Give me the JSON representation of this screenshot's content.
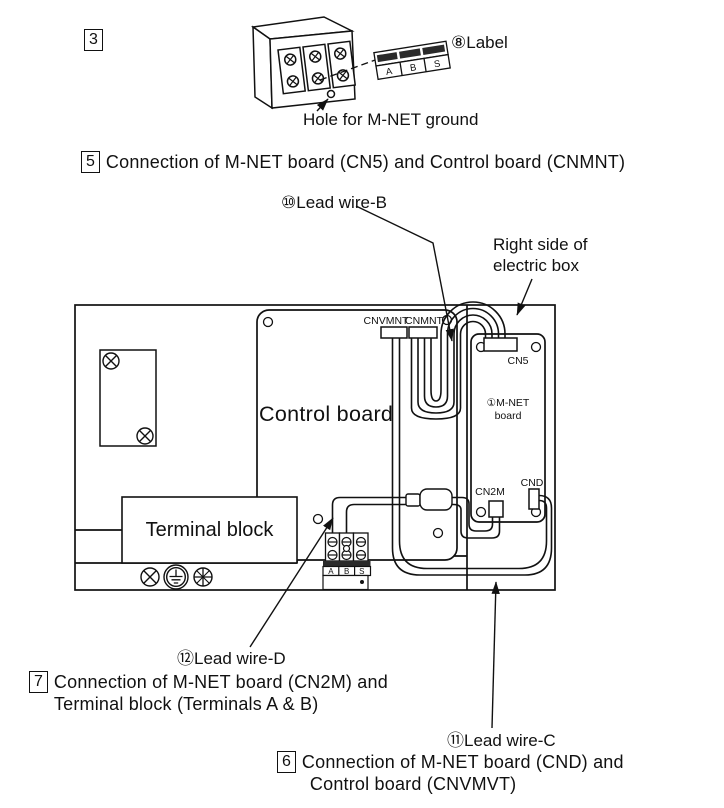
{
  "figure_top": {
    "step_number": "3",
    "label_callout": "⑧Label",
    "strip_cells": [
      "A",
      "B",
      "S"
    ],
    "hole_caption": "Hole for M-NET ground"
  },
  "section5": {
    "number": "5",
    "title": "Connection of M-NET board (CN5) and Control board (CNMNT)"
  },
  "callouts": {
    "lead_wire_b": "⑩Lead wire-B",
    "right_side_line1": "Right side of",
    "right_side_line2": "electric box",
    "lead_wire_d": "⑫Lead wire-D",
    "lead_wire_c": "⑪Lead wire-C"
  },
  "diagram": {
    "control_board": "Control board",
    "terminal_block": "Terminal block",
    "connectors": {
      "cnvmnt": "CNVMNT",
      "cnmnt": "CNMNT",
      "cn5": "CN5",
      "cn2m": "CN2M",
      "cnd": "CND"
    },
    "mnet_board_line1": "①M-NET",
    "mnet_board_line2": "board",
    "terminal_cells": [
      "A",
      "B",
      "S"
    ]
  },
  "section7": {
    "number": "7",
    "line1": "Connection of M-NET board (CN2M) and",
    "line2": "Terminal block (Terminals A & B)"
  },
  "section6": {
    "number": "6",
    "line1": "Connection of M-NET board (CND) and",
    "line2": "Control board (CNVMVT)"
  }
}
